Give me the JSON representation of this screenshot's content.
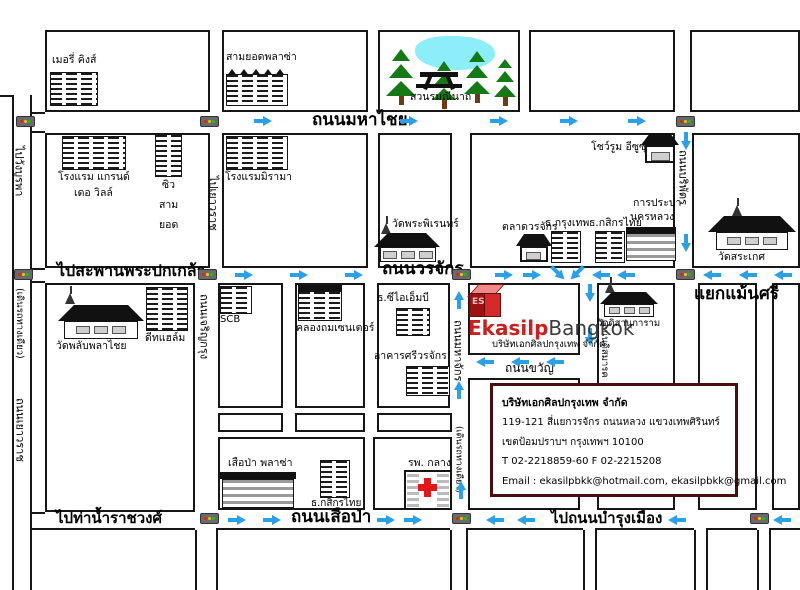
{
  "colors": {
    "arrow_blue": "#29a0e8",
    "brand_red": "#cc1f1f",
    "address_box_border": "#4a0f0f",
    "tree_green": "#157a15",
    "pond_cyan": "#8ceef8",
    "hospital_cross_red": "#e21818"
  },
  "icons": {
    "traffic_light": "css-shape",
    "arrow": "css-shape",
    "temple": "css-shape",
    "pine_tree": "css-shape",
    "pond": "css-shape",
    "picnic_table": "css-shape",
    "building": "css-stripes",
    "red_cross": "css-shape",
    "cube_logo": "css-shape"
  },
  "roads": {
    "mahachai": "ถนนมหาไชย",
    "worachak": "ถนนวรจักร",
    "to_phra_pokklao": "ไปสะพานพระปกเกล้า",
    "sueapa": "ถนนเสือป่า",
    "to_ratchawong_pier": "ไปท่าน้ำราชวงศ์",
    "to_bamrung_mueang": "ไปถนนบำรุงเมือง",
    "to_wang_burapha": "ไปวังบูรพา",
    "one_way_left": "(เดินรถทางเดียว)",
    "yaowarat": "ถนนเยาวราช",
    "to_yaowarat": "ไปเยาวราช",
    "charoen_krung": "ถนนเจริญกรุง",
    "mahachak": "ถนนมหาจักร",
    "one_way_mahachak": "(เดินรถทางเดียว)",
    "boriphat": "ถนนบริพัตร",
    "khwan": "ถนนขวัญ",
    "dismark": "ถนนดิสมารค",
    "maensi_junction": "แยกแม้นศรี"
  },
  "places": {
    "merry_kings": "เมอรี่ คิงส์",
    "samyod_plaza": "สามยอดพลาซ่า",
    "romaneenart_park": "สวนรมณีนาถ",
    "grand_de_ville_1": "โรงแรม แกรนด์",
    "grand_de_ville_2": "เดอ วิลล์",
    "siu": "ซิว",
    "sam": "สาม",
    "yod": "ยอด",
    "miramar_hotel": "โรงแรมมิรามา",
    "wat_phra_phiren": "วัดพระพิเรนทร์",
    "worachak_market": "ตลาดวรจักร",
    "bangkok_bank": "ธ.กรุงเทพ",
    "kasikorn_bank_top": "ธ.กสิกรไทย",
    "isuzu_showroom": "โชว์รูม อีซูซุ",
    "waterworks_1": "การประปา",
    "waterworks_2": "นครหลวง",
    "wat_saket": "วัดสระเกศ",
    "wat_phlapphlachai": "วัดพลับพลาไชย",
    "diethelm": "ดีทแฮล์ม",
    "scb": "SCB",
    "khlongthom_center": "คลองถมเซนเตอร์",
    "cimb_bank": "ธ.ซีไอเอ็มบี",
    "sri_worachak_bldg": "อาคารศรีวรจักร",
    "wat_disanukaram": "วัดดิสานุการาม",
    "sueapa_plaza": "เสือป่า พลาซ่า",
    "kasikorn_bank_bottom": "ธ.กสิกรไทย",
    "klang_hospital": "รพ. กลาง"
  },
  "logo": {
    "cube_letters": "ES",
    "brand_red_part": "Ekasilp",
    "brand_dark_part": "Bangkok",
    "subtitle": "บริษัทเอกศิลปกรุงเทพ จำกัด"
  },
  "company_box": {
    "name": "บริษัทเอกศิลปกรุงเทพ จำกัด",
    "address1": "119-121 สี่แยกวรจักร ถนนหลวง  แขวงเทพศิรินทร์",
    "address2": "เขตป้อมปราบฯ กรุงเทพฯ 10100",
    "phone": "T 02-2218859-60   F 02-2215208",
    "email": "Email : ekasilpbkk@hotmail.com, ekasilpbkk@gmail.com"
  }
}
